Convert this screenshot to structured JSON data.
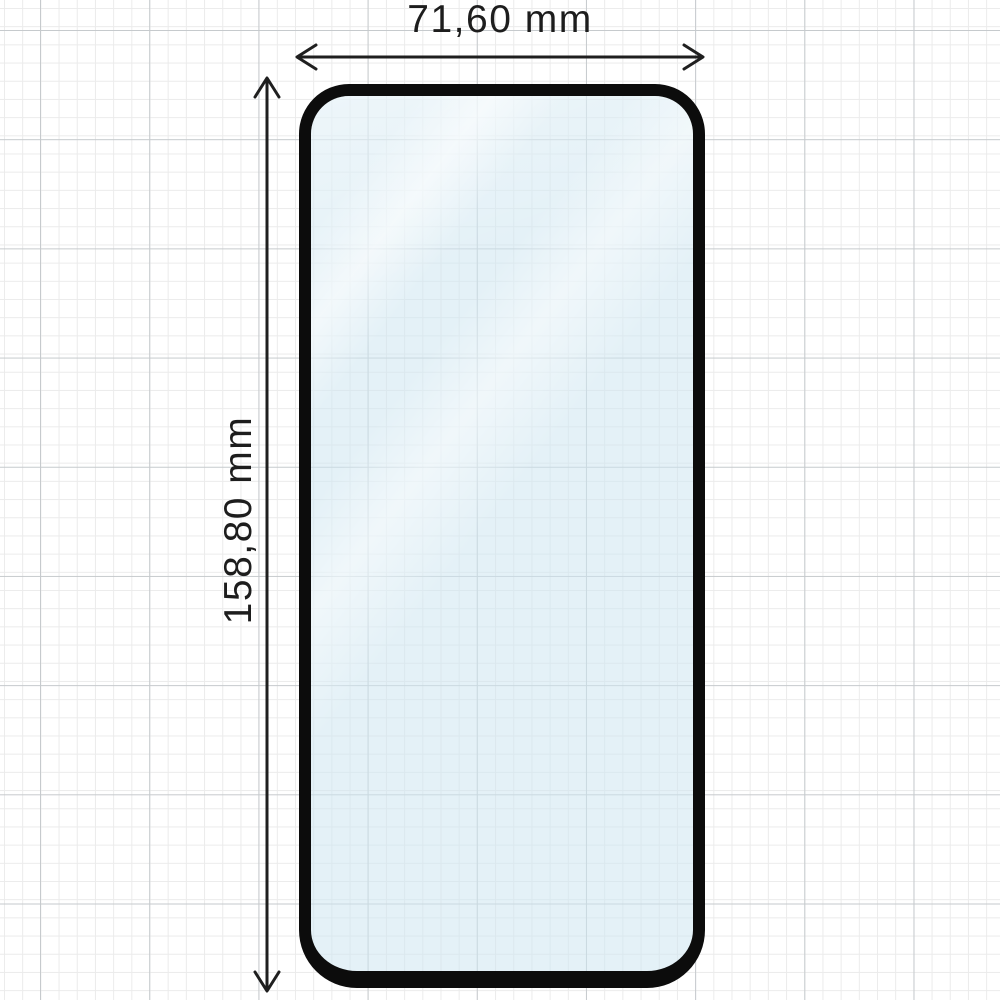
{
  "diagram": {
    "width_label": "71,60 mm",
    "height_label": "158,80 mm"
  },
  "colors": {
    "background": "#ffffff",
    "grid_minor": "#ebebeb",
    "grid_major": "#c6cacd",
    "line": "#1f1f1f",
    "label": "#1d1d1d",
    "glass_border": "#0c0c0c",
    "glass_tint": "rgba(206,229,241,0.55)"
  }
}
